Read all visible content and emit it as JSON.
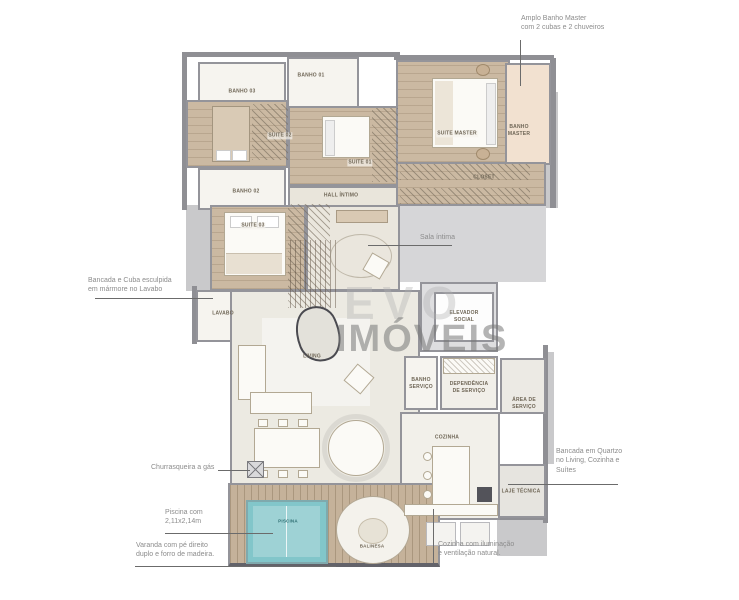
{
  "watermark": {
    "line1": "EVO",
    "line2": "IMÓVEIS"
  },
  "rooms": {
    "banho03": "BANHO 03",
    "banho01": "BANHO 01",
    "banho02": "BANHO 02",
    "suite02": "SUITE 02",
    "suite01": "SUITE 01",
    "suite03": "SUITE 03",
    "hall_intimo": "HALL ÍNTIMO",
    "suite_master": "SUITE MASTER",
    "banho_master": "BANHO\nMASTER",
    "closet": "CLOSET",
    "lavabo": "LAVABO",
    "living": "LIVING",
    "elevador_social": "ELEVADOR\nSOCIAL",
    "banho_servico": "BANHO\nSERVIÇO",
    "dependencia_servico": "DEPENDÊNCIA\nDE SERVIÇO",
    "area_servico": "ÁREA DE\nSERVIÇO",
    "cozinha": "COZINHA",
    "laje_tecnica": "LAJE TÉCNICA",
    "piscina": "PISCINA",
    "balinesa": "BALINESA"
  },
  "annotations": {
    "amplo_banho": "Amplo Banho Master\ncom 2 cubas e 2 chuveiros",
    "bancada_marmore": "Bancada e Cuba esculpida\nem mármore no Lavabo",
    "sala_intima": "Sala íntima",
    "churrasqueira": "Churrasqueira a gás",
    "piscina": "Piscina com\n2,11x2,14m",
    "varanda": "Varanda com pé direito\nduplo e forro de madeira.",
    "bancada_quartzo": "Bancada em Quartzo\nno Living, Cozinha e\nSuítes",
    "cozinha": "Cozinha com iluminação\ne ventilação natural."
  },
  "palette": {
    "wall": "#8f8f94",
    "wood_floor": "#cbb9a2",
    "light_floor": "#eceae2",
    "tile_floor": "#f6f4ef",
    "slab_gray": "#c9c9cb",
    "pool_water": "#82c6ca",
    "banho_master_floor": "#f2e1d0",
    "annotation_text": "#8c8c8c",
    "leader_line": "#6b6b6b",
    "watermark_gray": "#9b9b9b"
  }
}
